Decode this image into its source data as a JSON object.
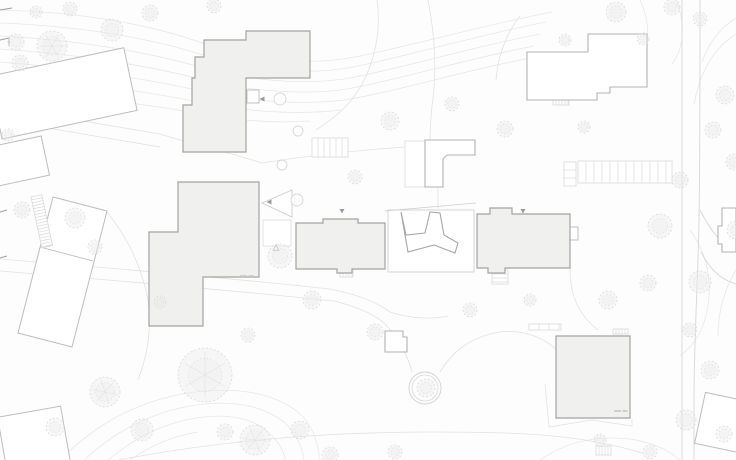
{
  "meta": {
    "canvas": {
      "width": 736,
      "height": 460,
      "background": "#fdfdfd"
    }
  },
  "palette": {
    "contour": "#e7e7e7",
    "path": "#e2e2e2",
    "road": "#dadada",
    "context_stroke": "#bdbdbd",
    "outline_stroke": "#b3b3b3",
    "filled_fill": "#f0f0ef",
    "filled_stroke": "#a3a3a3",
    "court_stroke": "#a8a8a8",
    "plot_stroke": "#d5d5d5",
    "tree_fill": "#ebebeb",
    "tree_stroke": "#d2d2d2",
    "marker": "#9a9a9a",
    "hatch": "#d9d9d9",
    "label": "#c9c9c9",
    "tick": "#9e9e9e",
    "white": "#ffffff"
  },
  "terrain": {
    "contours": [
      "M0,10 C80,12 150,24 205,44 C250,60 310,66 355,57 C410,46 480,26 552,12",
      "M0,23 C80,26 150,38 203,55 C248,70 308,76 353,67 C408,56 474,36 546,22",
      "M0,36 C78,40 148,52 200,67 C244,80 304,86 350,78 C402,68 468,48 540,34",
      "M0,49 C76,54 144,65 196,78 C240,90 300,96 347,89 C398,80 462,60 534,46",
      "M0,62 C74,68 140,78 192,89 C236,100 296,106 344,100 C395,92 458,72 530,58",
      "M0,75 C72,82 136,90 188,100 C232,110 292,116 341,110",
      "M0,88 C70,96 132,102 184,111 C224,119 270,124 310,121",
      "M640,0 C652,26 650,54 634,72",
      "M676,0 C686,24 684,48 672,64",
      "M736,18 C720,28 708,44 702,62",
      "M736,34 C714,48 700,72 694,104",
      "M60,460 C92,428 130,404 182,394 C232,385 272,392 298,412 C312,424 318,442 320,460",
      "M84,460 C112,434 146,414 190,406 C230,399 262,405 284,422 C296,433 302,446 304,460",
      "M108,460 C132,440 160,424 196,418 C228,413 252,418 268,432 C278,441 284,450 285,460",
      "M130,460 C150,446 172,436 198,432",
      "M540,460 C560,446 584,438 612,438 C640,438 664,446 680,460",
      "M690,230 C706,252 712,278 708,306 C705,326 696,344 680,356",
      "M736,270 C724,290 718,312 718,336"
    ]
  },
  "circulation": {
    "roads": [
      "M682,0 L682,460",
      "M700,0 C700,80 700,160 699,220 C698,280 694,340 694,400 L694,460",
      "M700,210 C712,234 724,246 736,252",
      "M701,252 C710,270 722,280 736,284"
    ],
    "walkways": [
      "M0,259 C110,268 230,278 330,289",
      "M0,271 C110,280 228,290 334,301",
      "M330,289 C360,295 378,303 390,312",
      "M334,301 C358,307 374,314 384,323",
      "M390,312 C408,318 430,320 448,316",
      "M384,323 C398,338 408,356 412,372",
      "M440,372 C452,352 468,340 490,334 C520,326 548,338 562,356",
      "M570,268 C570,298 580,316 598,330",
      "M118,460 C240,437 360,429 505,433 C565,435 606,442 642,453",
      "M107,212 C128,238 142,268 148,300 C152,328 148,354 138,380",
      "M160,134 C202,147 234,154 262,163",
      "M262,163 C312,155 360,150 406,147",
      "M377,0 C383,42 368,82 348,104 C339,114 328,122 316,130",
      "M428,0 C435,36 437,72 432,106 C431,118 430,130 430,140",
      "M438,187 L438,208",
      "M520,16 C506,34 498,56 496,80",
      "M545,384 L549,427 L592,420 L632,426 L632,419",
      "M0,107 L160,134",
      "M0,120 L160,147"
    ],
    "edge_ticks": [
      "0,10 12,8",
      "0,40 9,38 9,46",
      "0,212 7,210",
      "0,258 7,256"
    ]
  },
  "buildings": {
    "filled": [
      {
        "name": "building-north-l",
        "points": "204,40 246,40 246,31 310,31 310,78 246,78 246,152 183,152 183,105 192,105 192,78 195,78 195,57 204,57"
      },
      {
        "name": "building-west",
        "points": "178,182 259,182 259,277 203,277 203,326 149,326 149,232 178,232"
      },
      {
        "name": "building-center-west",
        "points": "296,223 323,223 323,219 358,219 358,223 385,223 385,269 352,269 352,273 337,273 337,269 296,269"
      },
      {
        "name": "building-center-east",
        "points": "477,214 490,214 490,208 512,208 512,214 570,214 570,268 505,268 505,273 488,273 488,268 477,268"
      },
      {
        "name": "building-south",
        "points": "556,336 630,336 630,418 556,418"
      }
    ],
    "outlined": [
      {
        "name": "building-northeast",
        "points": "527,52 588,52 588,34 647,34 647,87 610,87 610,93 597,93 597,100 527,100"
      },
      {
        "name": "building-center-small-l",
        "points": "425,140 475,140 475,155 447,155 443,159 443,187 425,187"
      },
      {
        "name": "building-south-hut",
        "points": "385,331 403,331 403,337 407,337 407,352 385,352"
      },
      {
        "name": "building-east-edge",
        "points": "722,208 736,208 736,252 722,252 722,244 718,244 718,226 722,226"
      }
    ],
    "courtyard": {
      "plot": {
        "x": 388,
        "y": 210,
        "w": 86,
        "h": 62
      },
      "footprint_points": "401,212 406,235 425,233 430,212 440,213 444,235 458,243 455,253 434,245 408,252",
      "canopy_line": {
        "x1": 385,
        "y1": 211,
        "x2": 476,
        "y2": 203
      }
    },
    "context": [
      {
        "name": "context-northwest",
        "rect": {
          "x": -6,
          "y": 62,
          "w": 138,
          "h": 64
        },
        "rot": -12,
        "cx": 60,
        "cy": 94
      },
      {
        "name": "context-west-small",
        "rect": {
          "x": -14,
          "y": 142,
          "w": 60,
          "h": 40
        },
        "rot": -12,
        "cx": 15,
        "cy": 162
      },
      {
        "name": "context-southwest-long",
        "points": "53,197 107,211 72,347 18,333",
        "divider": "40,247 93,261"
      },
      {
        "name": "context-southwest-corner",
        "rect": {
          "x": 2,
          "y": 412,
          "w": 64,
          "h": 58
        },
        "rot": -10,
        "cx": 30,
        "cy": 440
      },
      {
        "name": "context-southeast-corner",
        "rect": {
          "x": 700,
          "y": 396,
          "w": 48,
          "h": 52
        },
        "rot": 12,
        "cx": 720,
        "cy": 420
      }
    ],
    "annexes": [
      {
        "name": "annex-entry-north",
        "rect": {
          "x": 247,
          "y": 90,
          "w": 12,
          "h": 13
        }
      },
      {
        "name": "annex-east-stair",
        "rect": {
          "x": 570,
          "y": 227,
          "w": 8,
          "h": 13
        }
      },
      {
        "name": "annex-canopy-west",
        "rect": {
          "x": 405,
          "y": 141,
          "w": 20,
          "h": 46
        }
      },
      {
        "name": "annex-plaza-box",
        "rect": {
          "x": 263,
          "y": 220,
          "w": 28,
          "h": 26
        }
      }
    ],
    "ramp_points": "262,203 292,190 292,217"
  },
  "site_furniture": {
    "hatches": [
      {
        "name": "stair-northeast",
        "x": 553,
        "y": 98,
        "w": 16,
        "h": 7,
        "dir": "v",
        "gap": 3
      },
      {
        "name": "terrace-steps-north",
        "x": 312,
        "y": 138,
        "w": 36,
        "h": 19,
        "dir": "v",
        "gap": 6
      },
      {
        "name": "parking-row-east",
        "x": 578,
        "y": 161,
        "w": 94,
        "h": 22,
        "dir": "v",
        "gap": 8
      },
      {
        "name": "parking-cells-east",
        "x": 564,
        "y": 162,
        "w": 12,
        "h": 24,
        "dir": "h",
        "gap": 8
      },
      {
        "name": "stair-center-west",
        "x": 340,
        "y": 269,
        "w": 13,
        "h": 8,
        "dir": "v",
        "gap": 3
      },
      {
        "name": "stair-center-east",
        "x": 492,
        "y": 270,
        "w": 16,
        "h": 14,
        "dir": "h",
        "gap": 4
      },
      {
        "name": "bike-racks-south",
        "x": 596,
        "y": 446,
        "w": 15,
        "h": 9,
        "dir": "v",
        "gap": 3
      },
      {
        "name": "stair-south-building",
        "x": 613,
        "y": 329,
        "w": 15,
        "h": 5,
        "dir": "v",
        "gap": 3
      },
      {
        "name": "bike-racks-south-building",
        "x": 529,
        "y": 324,
        "w": 32,
        "h": 6,
        "dir": "v",
        "gap": 10
      },
      {
        "name": "ramp-west-stairs",
        "x": 31,
        "y": 197,
        "w": 11,
        "h": 52,
        "dir": "h",
        "gap": 3,
        "rot": -12
      }
    ],
    "shrub_rings": [
      {
        "cx": 280,
        "cy": 99,
        "r": 6
      },
      {
        "cx": 298,
        "cy": 131,
        "r": 5
      },
      {
        "cx": 282,
        "cy": 165,
        "r": 5
      },
      {
        "cx": 297,
        "cy": 200,
        "r": 6
      }
    ],
    "planter": {
      "cx": 425,
      "cy": 388,
      "r_outer": 16,
      "r_inner": 13
    },
    "recycle_point": {
      "x": 276,
      "y": 248
    }
  },
  "markers": {
    "entrance_arrows": [
      {
        "x": 262,
        "y": 99,
        "dir": "left"
      },
      {
        "x": 269,
        "y": 202,
        "dir": "left"
      },
      {
        "x": 342,
        "y": 211,
        "dir": "down"
      },
      {
        "x": 523,
        "y": 211,
        "dir": "down"
      }
    ],
    "elevation_marks": [
      {
        "x": 240,
        "y": 275
      },
      {
        "x": 614,
        "y": 410
      }
    ]
  },
  "trees": [
    [
      52,
      46,
      15
    ],
    [
      112,
      30,
      11
    ],
    [
      150,
      13,
      8
    ],
    [
      214,
      6,
      7
    ],
    [
      70,
      9,
      7
    ],
    [
      16,
      42,
      8
    ],
    [
      36,
      12,
      6
    ],
    [
      390,
      121,
      9
    ],
    [
      452,
      104,
      7
    ],
    [
      505,
      129,
      8
    ],
    [
      584,
      127,
      6
    ],
    [
      616,
      12,
      10
    ],
    [
      672,
      7,
      8
    ],
    [
      700,
      19,
      7
    ],
    [
      643,
      39,
      6
    ],
    [
      565,
      40,
      6
    ],
    [
      725,
      95,
      9
    ],
    [
      713,
      130,
      8
    ],
    [
      734,
      162,
      8
    ],
    [
      20,
      63,
      8
    ],
    [
      8,
      135,
      6
    ],
    [
      22,
      210,
      8
    ],
    [
      75,
      218,
      10
    ],
    [
      95,
      247,
      7
    ],
    [
      280,
      256,
      12
    ],
    [
      355,
      177,
      7
    ],
    [
      312,
      300,
      9
    ],
    [
      160,
      302,
      6
    ],
    [
      248,
      335,
      7
    ],
    [
      375,
      332,
      8
    ],
    [
      205,
      375,
      27
    ],
    [
      255,
      440,
      15
    ],
    [
      300,
      430,
      9
    ],
    [
      225,
      432,
      8
    ],
    [
      330,
      455,
      8
    ],
    [
      395,
      452,
      7
    ],
    [
      105,
      392,
      15
    ],
    [
      142,
      430,
      11
    ],
    [
      55,
      427,
      9
    ],
    [
      426,
      388,
      9
    ],
    [
      470,
      310,
      7
    ],
    [
      530,
      300,
      6
    ],
    [
      608,
      300,
      9
    ],
    [
      648,
      283,
      8
    ],
    [
      700,
      282,
      11
    ],
    [
      660,
      226,
      12
    ],
    [
      680,
      180,
      8
    ],
    [
      736,
      230,
      9
    ],
    [
      690,
      330,
      7
    ],
    [
      710,
      370,
      9
    ],
    [
      686,
      420,
      10
    ],
    [
      724,
      434,
      8
    ],
    [
      650,
      452,
      7
    ],
    [
      600,
      440,
      6
    ]
  ]
}
